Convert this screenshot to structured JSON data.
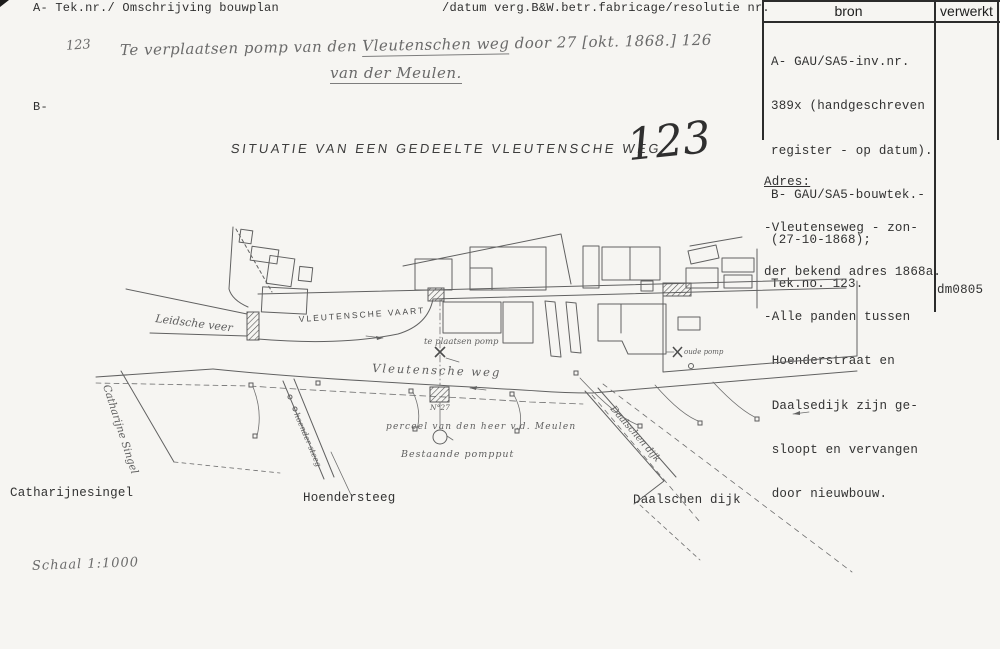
{
  "header": {
    "left_label": "A- Tek.nr./ Omschrijving bouwplan",
    "mid_label": "/datum verg.B&W.betr.fabricage/resolutie nr.",
    "b_marker": "B-"
  },
  "bron_table": {
    "bron_header": "bron",
    "verwerkt_header": "verwerkt",
    "bron_lines": [
      "A- GAU/SA5-inv.nr.",
      "389x (handgeschreven",
      "register - op datum).",
      "B- GAU/SA5-bouwtek.-",
      "(27-10-1868);",
      "Tek.no. 123."
    ]
  },
  "handwriting": {
    "number": "123",
    "line1_pre": "Te verplaatsen pomp van den ",
    "line1_underlined": "Vleutenschen weg",
    "line1_post": " door 27 [okt. 1868.] 126",
    "line2": "van der Meulen.",
    "big_number": "123",
    "schaal": "Schaal 1:1000"
  },
  "adres": {
    "heading": "Adres:",
    "lines": [
      "-Vleutenseweg - zon-",
      "der bekend adres 1868a.",
      "-Alle panden tussen",
      " Hoenderstraat en",
      " Daalsedijk zijn ge-",
      " sloopt en vervangen",
      " door nieuwbouw."
    ],
    "code": "dm0805"
  },
  "map": {
    "title": "SITUATIE VAN EEN GEDEELTE VLEUTENSCHE WEG",
    "labels": {
      "leidsche_veer": "Leidsche veer",
      "vleutensche_vaart": "VLEUTENSCHE VAART",
      "vleutensche_weg": "Vleutensche weg",
      "te_plaatsen_pomp": "te plaatsen pomp",
      "oude_pomp": "oude pomp",
      "perceel_nr": "N°27",
      "perceel": "perceel van den heer v.d. Meulen",
      "bestaande_pompput": "Bestaande pompput",
      "catharijne_singel": "Catharijne Singel",
      "hoender_steeg": "hoender steeg",
      "daalschen_dijk_hand": "Daalschen dijk",
      "catharijnesingel_typed": "Catharijnesingel",
      "hoendersteeg_typed": "Hoendersteeg",
      "daalschen_dijk_typed": "Daalschen dijk"
    }
  },
  "colors": {
    "paper": "#f6f5f2",
    "ink_typed": "#2f2f2f",
    "ink_hand": "#6a6a6a",
    "ink_map": "#616161",
    "table_border": "#2c2c2c"
  }
}
